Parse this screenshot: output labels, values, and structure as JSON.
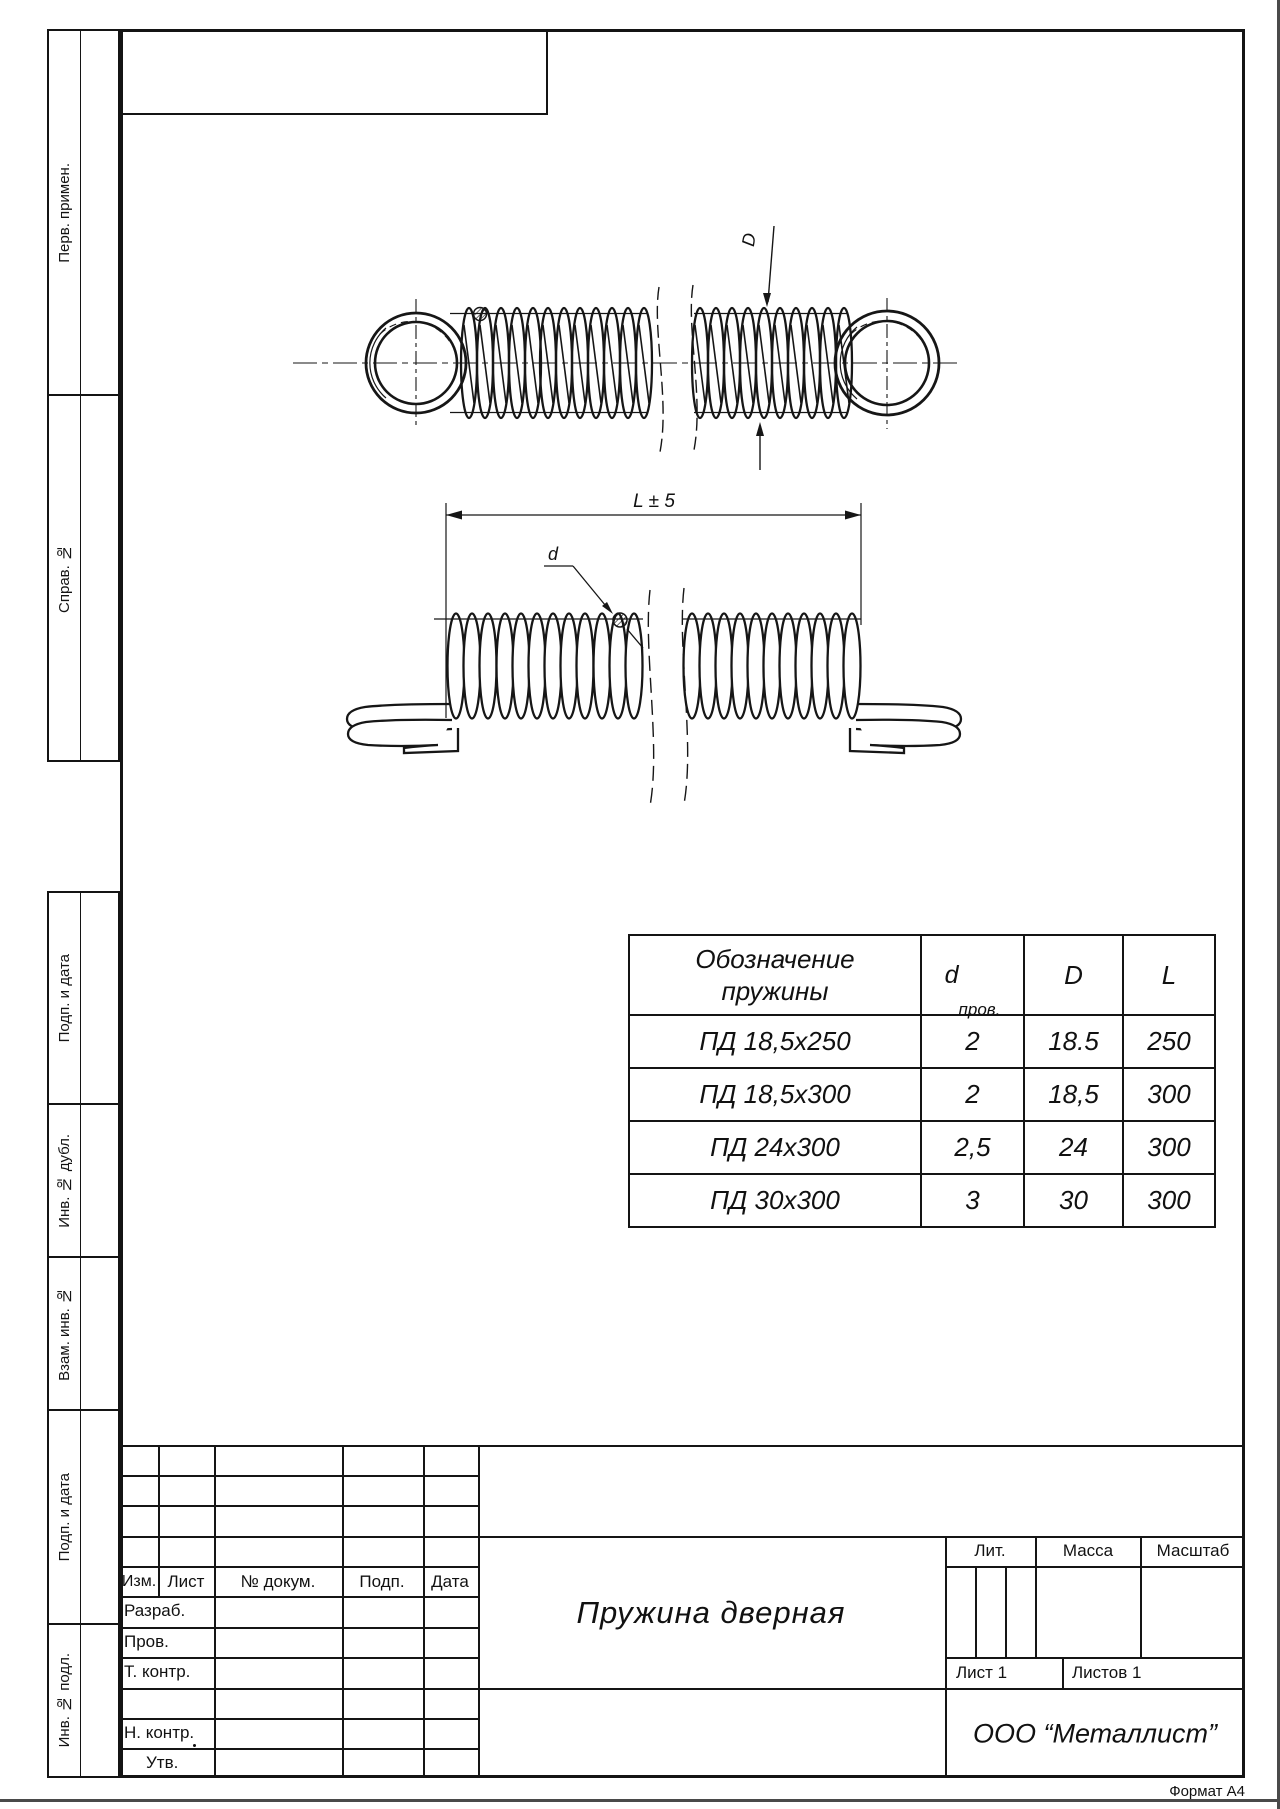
{
  "page": {
    "format_label": "Формат А4"
  },
  "side_labels": [
    {
      "label": "Перв. примен."
    },
    {
      "label": "Справ. №"
    },
    {
      "label": "Подп. и дата"
    },
    {
      "label": "Инв. № дубл."
    },
    {
      "label": "Взам. инв. №"
    },
    {
      "label": "Подп. и дата"
    },
    {
      "label": "Инв. № подл."
    }
  ],
  "drawing": {
    "dim_outer_diameter_label": "D",
    "dim_wire_diameter_label": "d",
    "dim_length_label": "L ± 5"
  },
  "spring_table": {
    "header": {
      "name_line1": "Обозначение",
      "name_line2": "пружины",
      "wire_d": "d",
      "wire_d_sub": "пров.",
      "outer_d": "D",
      "length": "L"
    },
    "rows": [
      {
        "name": "ПД 18,5х250",
        "wire_d": "2",
        "outer_d": "18.5",
        "length": "250"
      },
      {
        "name": "ПД 18,5х300",
        "wire_d": "2",
        "outer_d": "18,5",
        "length": "300"
      },
      {
        "name": "ПД 24х300",
        "wire_d": "2,5",
        "outer_d": "24",
        "length": "300"
      },
      {
        "name": "ПД 30х300",
        "wire_d": "3",
        "outer_d": "30",
        "length": "300"
      }
    ]
  },
  "title_block": {
    "header_cols": {
      "izm": "Изм.",
      "list": "Лист",
      "dokum": "№ докум.",
      "podp": "Подп.",
      "data": "Дата"
    },
    "approval_rows": [
      {
        "label": "Разраб."
      },
      {
        "label": "Пров."
      },
      {
        "label": "Т. контр."
      },
      {
        "label": "Н. контр."
      },
      {
        "label": "Утв."
      }
    ],
    "part_name": "Пружина дверная",
    "lit_label": "Лит.",
    "mass_label": "Масса",
    "scale_label": "Масштаб",
    "sheet_label": "Лист 1",
    "sheets_label": "Листов 1",
    "company": "ООО “Металлист”"
  }
}
